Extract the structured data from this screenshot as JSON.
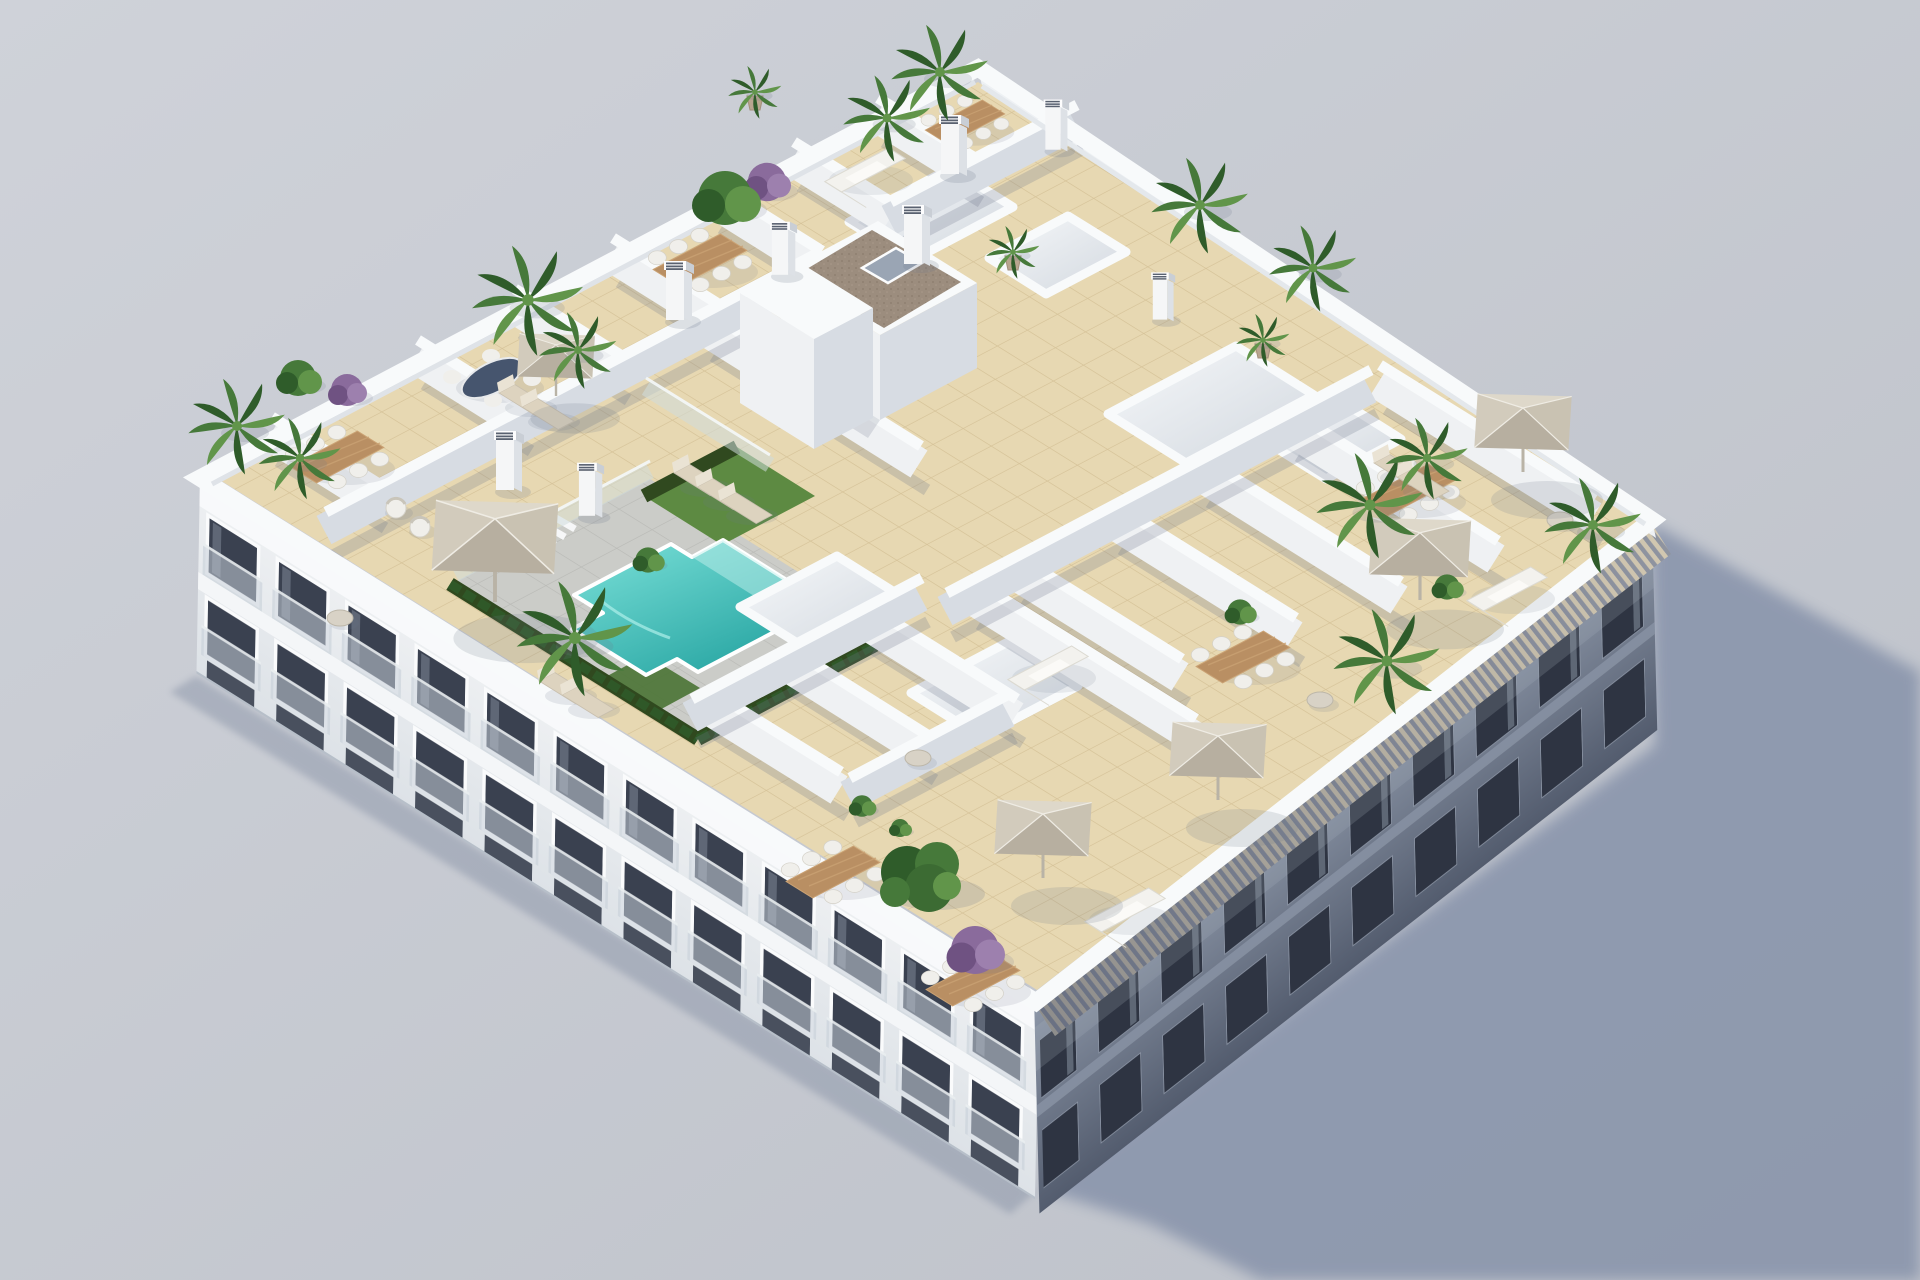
{
  "meta": {
    "domain": "natural-image",
    "visible_text": "none",
    "description": "Aerial isometric 3D architectural render of a white residential apartment block viewed from above, showing the rooftop terrace level and two street facades, on a plain light-grey studio background with a soft blue-grey shadow cast to the lower right."
  },
  "scene": {
    "type": "3d-architectural-render",
    "camera": "aerial-isometric from upper-left",
    "lighting": "sun from upper-left, shadow cast to lower-right",
    "building": {
      "stories_visible": 4,
      "facade_material": "white stucco with recessed dark windows and glass balconies",
      "roof_floor": "beige ceramic tiles",
      "communal_area": "gray paved pool deck with turquoise swimming pool and artificial grass",
      "right_edge_feature": "wooden louvre pergola strip along shaded facade",
      "core": "central stair/lift core with brown gravel flat roof and glass skylight"
    },
    "objects": {
      "swimming_pool": 1,
      "grass_areas": 2,
      "sun_umbrellas": 6,
      "dining_sets": 7,
      "oval_dining_set": 1,
      "sun_loungers": 9,
      "outdoor_sofas": 4,
      "armchairs": 2,
      "round_side_tables": 4,
      "skylight_wells": 6,
      "chimney_stacks": 8,
      "terrace_divider_walls": 22,
      "palm_plants": 14,
      "green_shrubs": 7,
      "purple_shrubs": 3,
      "large_tree": 1,
      "glass_railings": 2,
      "stair_flights": 1
    }
  },
  "colors": {
    "bg1": "#cfd2d9",
    "bg2": "#bdc1c9",
    "shadow": "#8793aa",
    "tile": "#e7d8b2",
    "tileline": "#d5c298",
    "tilelight": "#eee1c2",
    "deck": "#cbccc8",
    "deckline": "#b9bab6",
    "pool1": "#7de2da",
    "pool2": "#2aa7a4",
    "pooledge": "#c2f0ec",
    "grass": "#5d8a42",
    "grassdark": "#4a7334",
    "hedge": "#30491f",
    "walltop": "#f8fafb",
    "wallsidelit": "#eff1f3",
    "wallsideshade": "#d7dce3",
    "wallshadow": "#6e788c",
    "facade": "#eff1f3",
    "facadeband": "#f8f9fb",
    "windark": "#3a4150",
    "balglass": "#c5ced6",
    "shade1": "#8d97a8",
    "shade2": "#535c6e",
    "winshade": "#2e3442",
    "slat": "#d2c8b1",
    "slatgap": "#8f94a0",
    "coreroof": "#9c8d7e",
    "coreroofdot": "#8a7b6c",
    "skylight": "#9aa5b4",
    "wood": "#b98f63",
    "woodlight": "#caa274",
    "seat": "#f0efeb",
    "cushion": "#ddd3bf",
    "umb1": "#ded8ca",
    "umb2": "#c9c2b2",
    "umb3": "#b7afa0",
    "umb4": "#d2cbbc",
    "leaf": "#46793a",
    "leafdark": "#2f5c2a",
    "leaflight": "#61954a",
    "purple": "#8a6b9c",
    "purpledark": "#6f5282",
    "pot": "#b9a58f",
    "trunk": "#7a6a52",
    "glassfence": "#cfdcdd"
  }
}
